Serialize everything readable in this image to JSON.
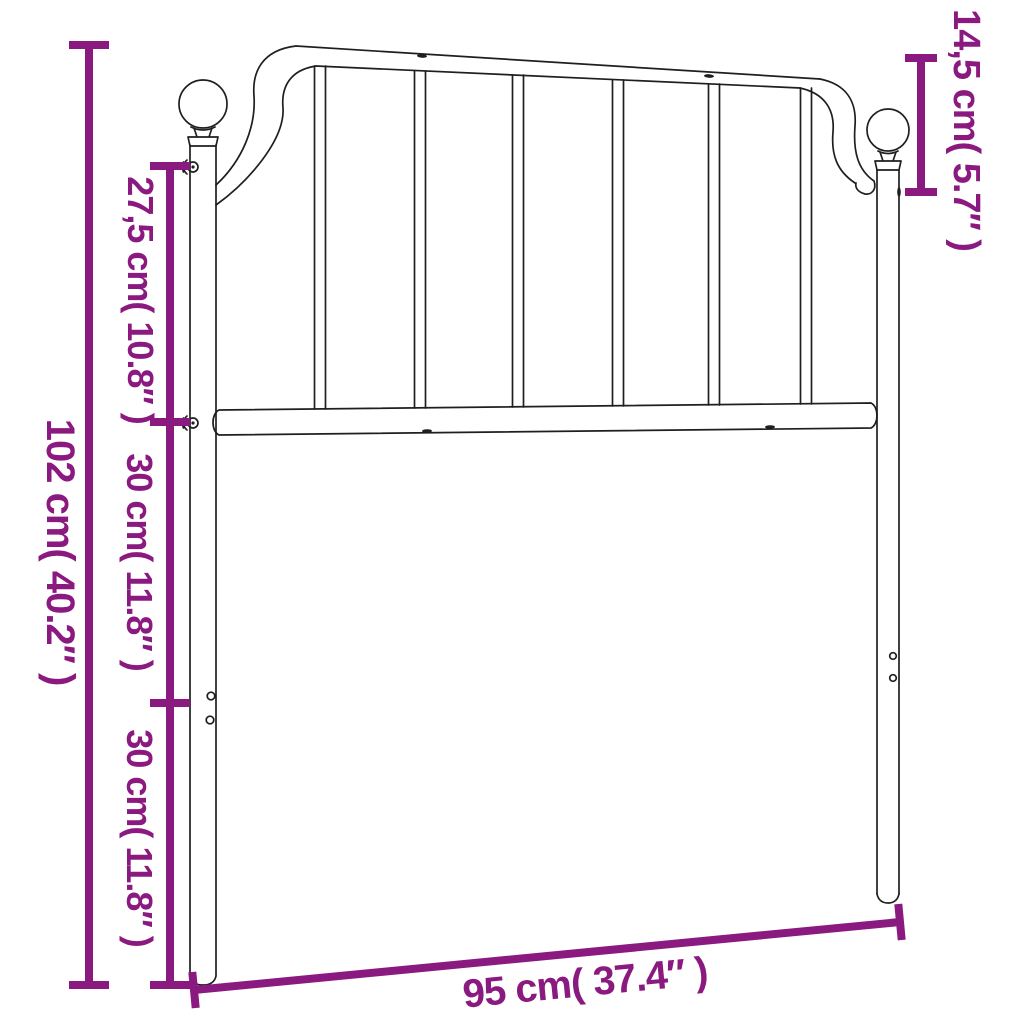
{
  "diagram": {
    "accent_color": "#8B1A80",
    "line_color": "#1f1f1f",
    "labels": {
      "total_height": "102 cm( 40.2″ )",
      "upper_section": "27,5 cm( 10.8″ )",
      "middle_section": "30 cm( 11.8″ )",
      "lower_section": "30 cm( 11.8″ )",
      "finial_drop": "14,5 cm( 5.7″ )",
      "width": "95 cm( 37.4″ )"
    }
  }
}
